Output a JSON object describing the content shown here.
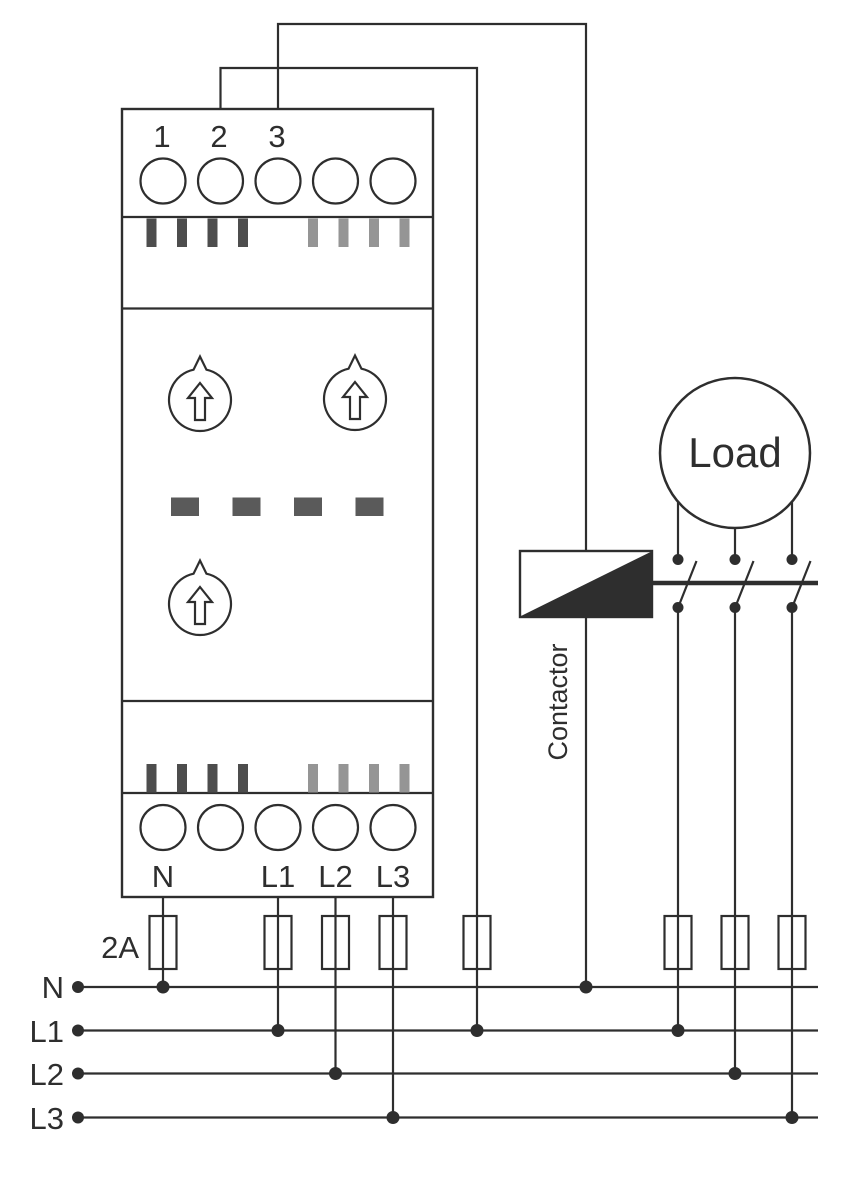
{
  "diagram_title": "Three-phase monitoring relay wiring diagram",
  "colors": {
    "line": "#2e2e2e",
    "stripe-dark": "#4d4d4d",
    "stripe-light": "#959595",
    "dash": "#5a5a5a",
    "background": "#ffffff"
  },
  "device": {
    "top_terminal_labels": [
      "1",
      "2",
      "3"
    ],
    "bottom_terminal_labels": [
      "N",
      "L1",
      "L2",
      "L3"
    ],
    "top_terminal_count": 5,
    "bottom_terminal_count": 5,
    "dial_count": 3
  },
  "icons": {
    "dial": "up-arrow-rotary-dial",
    "fuse": "iec-fuse-rect",
    "junction": "filled-dot"
  },
  "fuses": {
    "rating_label": "2A"
  },
  "contactor": {
    "label": "Contactor"
  },
  "load": {
    "label": "Load"
  },
  "bus": {
    "labels": [
      "N",
      "L1",
      "L2",
      "L3"
    ]
  }
}
